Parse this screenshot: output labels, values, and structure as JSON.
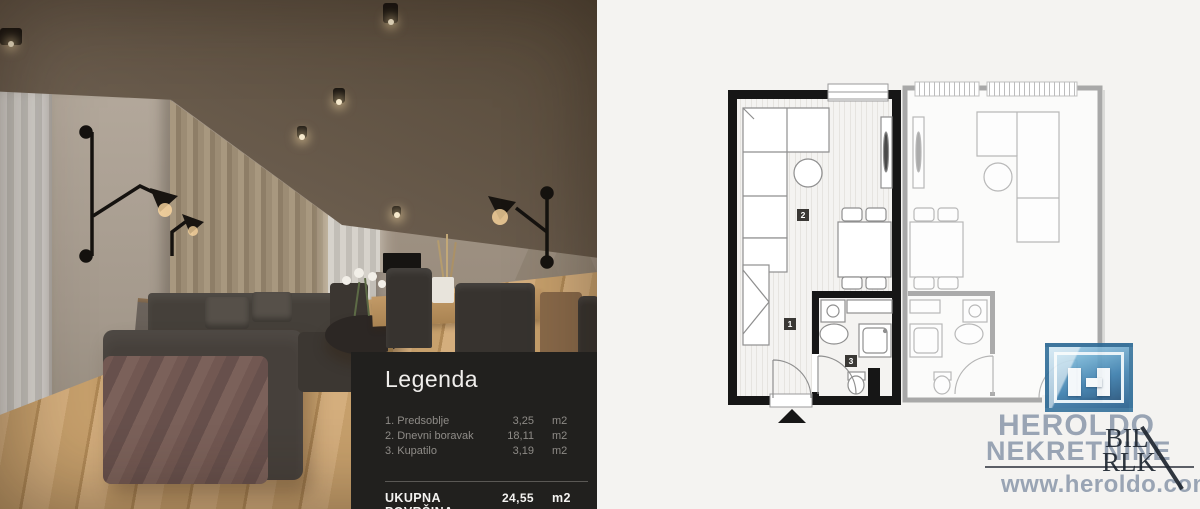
{
  "legend": {
    "title": "Legenda",
    "items": [
      {
        "label": "1. Predsoblje",
        "area": "3,25",
        "unit": "m2"
      },
      {
        "label": "2. Dnevni boravak",
        "area": "18,11",
        "unit": "m2"
      },
      {
        "label": "3. Kupatilo",
        "area": "3,19",
        "unit": "m2"
      }
    ],
    "total": {
      "label": "UKUPNA POVRŠINA",
      "area": "24,55",
      "unit": "m2"
    }
  },
  "floorplan": {
    "labels": {
      "hallway": "1",
      "living_room": "2",
      "bathroom": "3"
    }
  },
  "branding": {
    "name_line1": "HEROLDO",
    "name_line2": "NEKRETNINE",
    "website": "www.heroldo.com",
    "watermark_line1": "BIL",
    "watermark_line2": "RLK"
  },
  "colors": {
    "brand_blue": "#4a89b5",
    "brand_text": "#8d9aac",
    "legend_bg": "#21201e",
    "plan_wall": "#161616",
    "plan_neighbor_wall": "#a8a8a8",
    "canvas_bg": "#f4f3f1",
    "floor_wood": "#c7a06c"
  }
}
